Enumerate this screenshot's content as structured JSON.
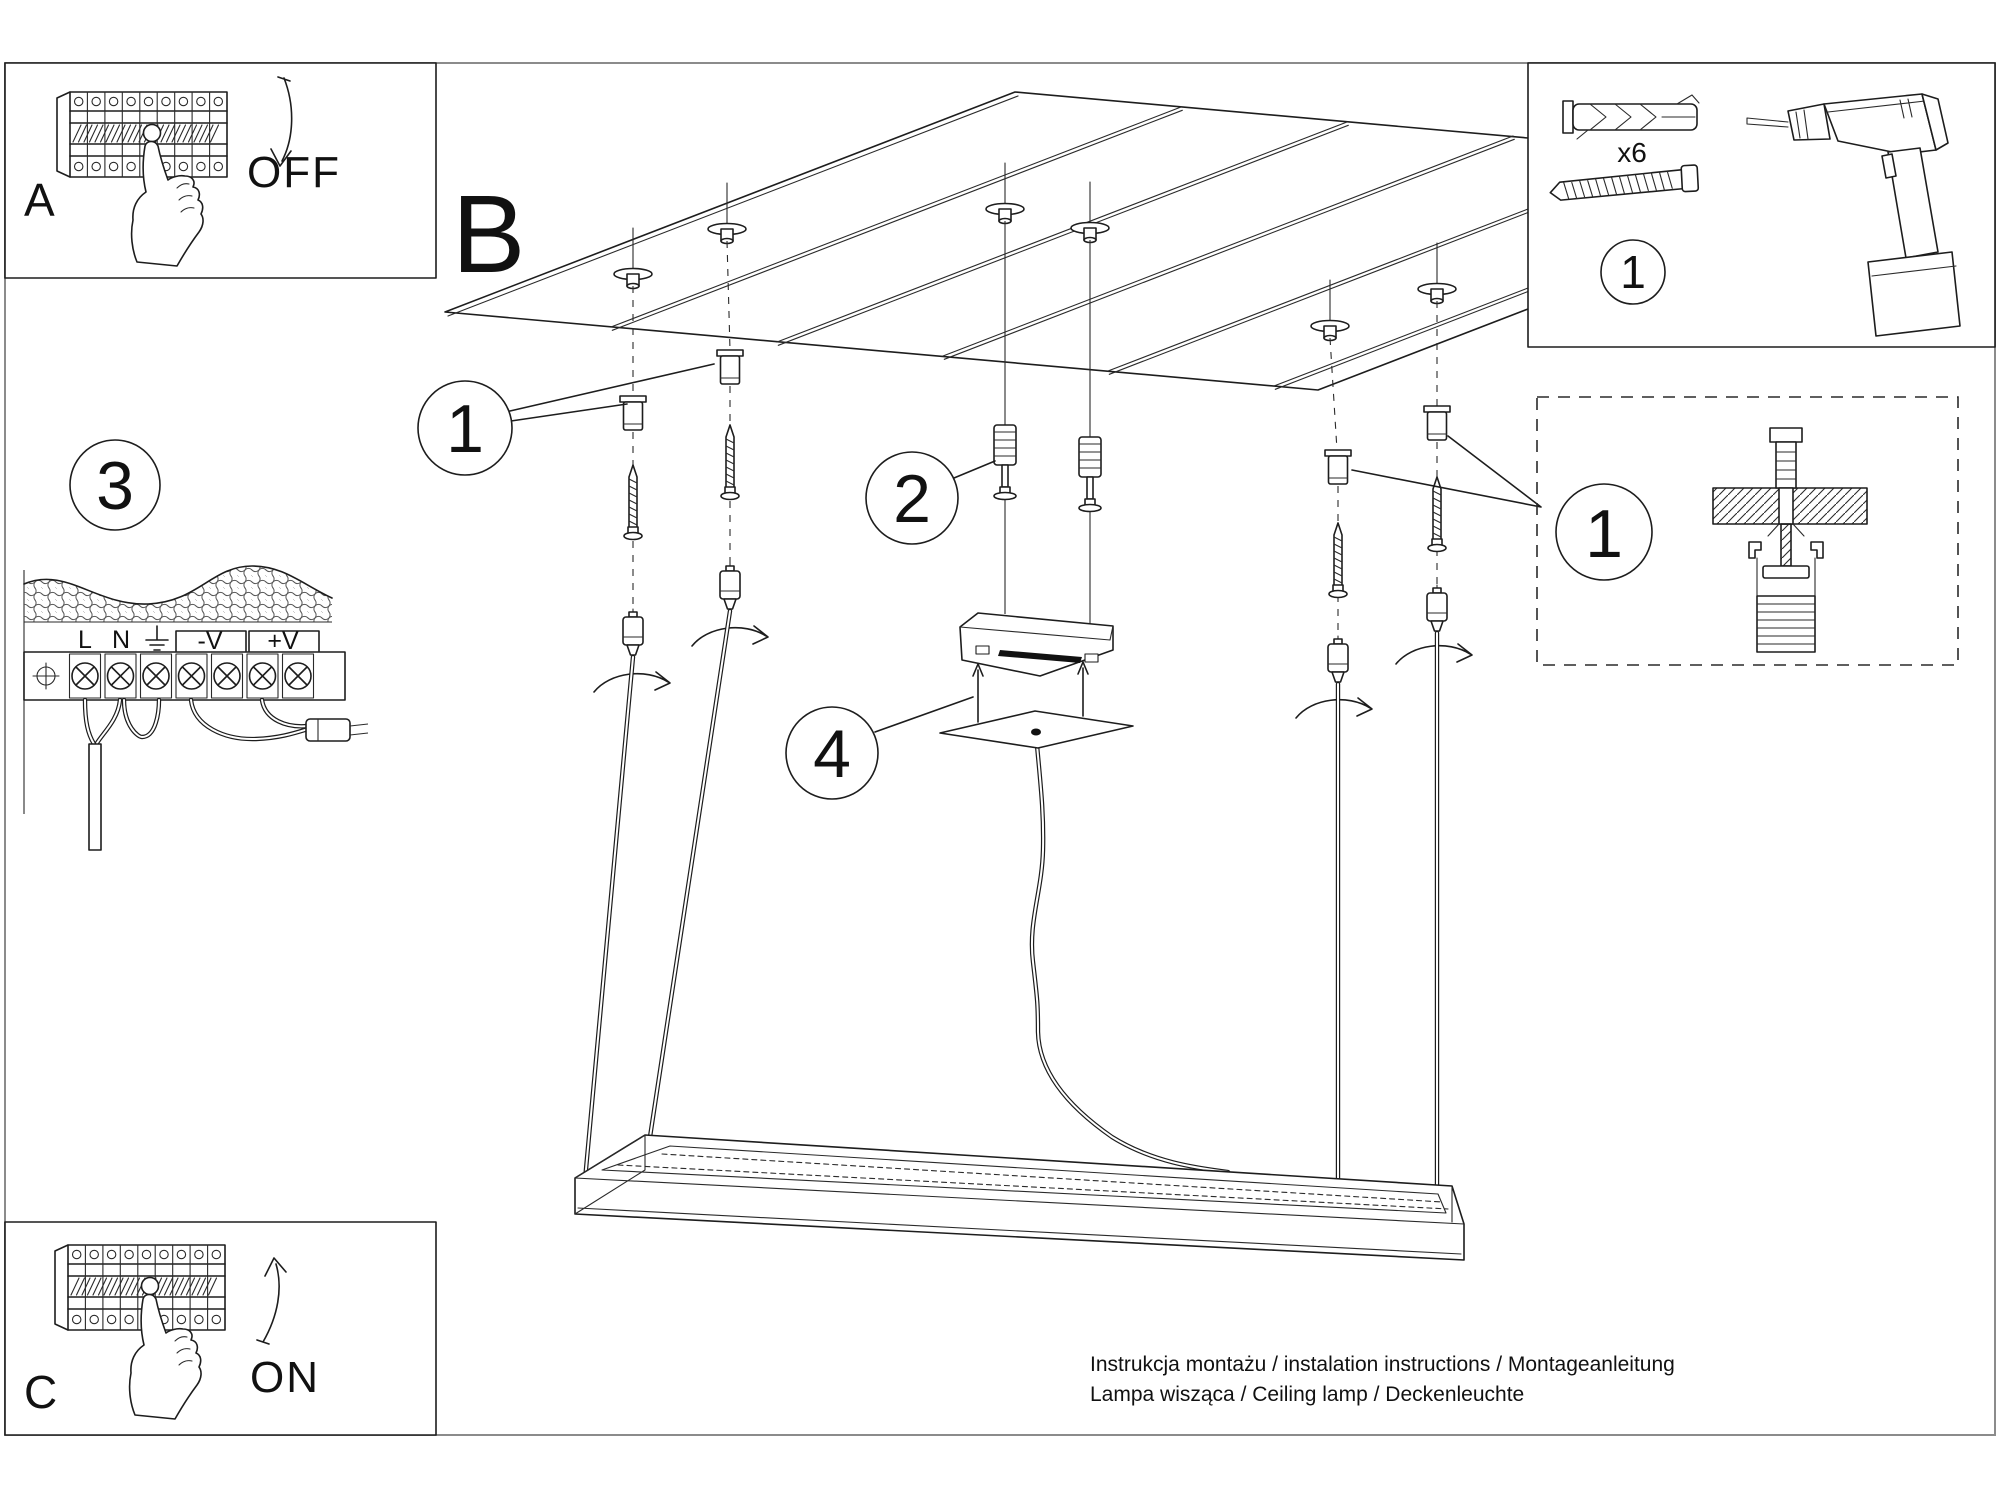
{
  "panel_a": {
    "letter": "A",
    "action": "OFF"
  },
  "panel_c": {
    "letter": "C",
    "action": "ON"
  },
  "section_b": {
    "letter": "B"
  },
  "steps": {
    "one": "1",
    "two": "2",
    "three": "3",
    "four": "4"
  },
  "parts_box": {
    "step": "1",
    "screw_qty": "x6"
  },
  "detail_box": {
    "step": "1"
  },
  "wiring": {
    "terminal_labels": [
      "L",
      "N",
      "-V",
      "+V"
    ]
  },
  "footer": {
    "line1": "Instrukcja montażu / instalation instructions / Montageanleitung",
    "line2": "Lampa wisząca / Ceiling lamp / Deckenleuchte"
  },
  "icons": {
    "breaker_panel": "circuit-breaker-row",
    "hand": "pressing-hand",
    "arrow_off": "curved-arrow-down",
    "arrow_on": "curved-arrow-up",
    "drill": "power-drill",
    "wall_plug": "expansion-anchor",
    "screw": "mounting-screw",
    "gripper": "cable-gripper",
    "rotation": "rotate-arrow",
    "earth": "ground-symbol"
  },
  "colors": {
    "ink": "#1d1d1d",
    "page_border": "#8b8b8b",
    "background": "#ffffff"
  }
}
